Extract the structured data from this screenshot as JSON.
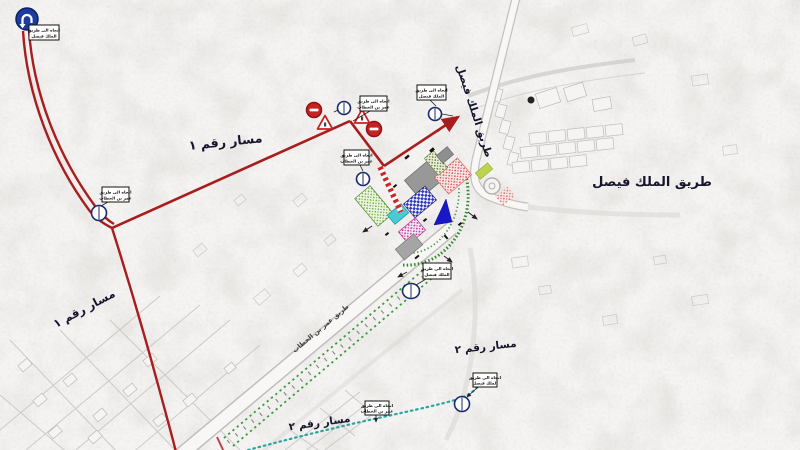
{
  "map": {
    "labels": {
      "route1_top": "مسار رقم ١",
      "route1_left": "مسار رقم ١",
      "route2_bottom": "مسار رقم ٢",
      "route2_right": "مسار رقم ٢",
      "king_faisal_bold": "طريق الملك فيصل",
      "king_faisal_along": "طريق الملك فيصل",
      "omar_along": "طريق عمر بن الخطاب"
    },
    "callouts": [
      {
        "line1": "اتجاه الى طريق",
        "line2": "الملك فيصل"
      },
      {
        "line1": "اتجاه الى طريق",
        "line2": "عمر بن الخطاب"
      },
      {
        "line1": "اتجاه الى طريق",
        "line2": "الملك فيصل"
      },
      {
        "line1": "اتجاه الى طريق",
        "line2": "عمر بن الخطاب"
      },
      {
        "line1": "اتجاه الى طريق",
        "line2": "عمر بن الخطاب"
      },
      {
        "line1": "اتجاه الى طريق",
        "line2": "الملك فيصل"
      },
      {
        "line1": "اتجاه الى طريق",
        "line2": "عمر بن الخطاب"
      },
      {
        "line1": "اتجاه الى طريق",
        "line2": "الملك فيصل"
      }
    ],
    "icons": {
      "start": "u-turn-mandatory-sign",
      "detour_point": "detour-point-sign",
      "no_entry": "no-entry-sign",
      "warning": "roadworks-warning-triangle"
    },
    "colors": {
      "route1_red": "#a81d1d",
      "route2_teal": "#2ba6a0",
      "green_path": "#2e8b2e",
      "sign_blue": "#1d3ca0",
      "no_entry_red": "#c62222"
    }
  }
}
